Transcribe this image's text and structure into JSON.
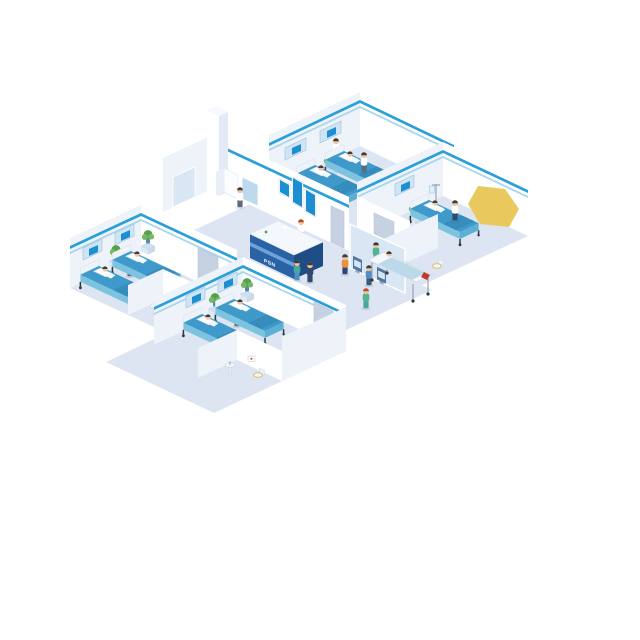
{
  "scene": {
    "subject": "Isometric hospital floor-plan illustration",
    "reception_sign": "PSN",
    "wards": [
      {
        "id": "ward-top",
        "beds": 2,
        "patients": 2,
        "staff": 2,
        "features": [
          "headboard-panels",
          "plant"
        ]
      },
      {
        "id": "ward-right",
        "beds": 1,
        "patients": 1,
        "staff": 1,
        "features": [
          "iv-drip",
          "plant",
          "bathroom"
        ]
      },
      {
        "id": "ward-left",
        "beds": 2,
        "patients": 2,
        "staff": 1,
        "features": [
          "headboard-panels",
          "plants",
          "bathroom"
        ]
      },
      {
        "id": "ward-bottom",
        "beds": 2,
        "patients": 2,
        "staff": 1,
        "features": [
          "headboard-panels",
          "plants",
          "bathroom"
        ]
      }
    ],
    "lobby": {
      "features": [
        "reception-desk",
        "receptionist",
        "wall-display-screens",
        "self-checkin-kiosks"
      ],
      "wall_screens": 3,
      "kiosks": 2,
      "kiosk_users": 2
    },
    "corridor": {
      "people": [
        "doctor-dark-scrubs",
        "assistant-blue",
        "nurse-green-walking"
      ],
      "gurney": {
        "patients": 1,
        "attendants": 1
      }
    },
    "lab_storage": {
      "features": [
        "utility-column",
        "glass-door",
        "medical-cabinet",
        "glass-cabinet",
        "technician"
      ]
    },
    "bathrooms": 3,
    "highlight": {
      "shape": "yellow-polygon",
      "position": "upper-right"
    }
  },
  "palette": {
    "floor": "#dde4f2",
    "wallWhite": "#ffffff",
    "wallShade": "#eef3fa",
    "stripeBlue": "#2b9fd8",
    "stripeLight": "#a9d6ee",
    "panelBlue": "#cfe4f4",
    "screenBlue": "#1d8ed1",
    "doorGray": "#c6d2e2",
    "glassBlue": "#d9e6f4",
    "cabinetBlue": "#bcd9ee",
    "bedTop": "#3e9aca",
    "bedTopDark": "#368cba",
    "bedSide": "#7cc3e0",
    "bedFoot": "#5cb0d6",
    "pillow": "#ffffff",
    "legDark": "#2e3744",
    "metal": "#98a5b3",
    "skin": "#f1c49e",
    "hair": "#3c3c3c",
    "hairRed": "#b2502e",
    "coat": "#ffffff",
    "scrubsGreen": "#55b391",
    "teal": "#4aa6a0",
    "navy": "#2f4a6e",
    "pantsGray": "#5d6b7c",
    "shirtOrange": "#e8923e",
    "shirtBlue": "#4f8fc9",
    "deskFront": "#2a63a5",
    "deskSide": "#1e4d85",
    "deskBand": "#6ea3d8",
    "deskTop": "#f4f8fc",
    "kioskBody": "#55799f",
    "kioskScreen": "#cfe7f7",
    "plantGreen": "#55a04b",
    "plantLight": "#74b961",
    "potBlue": "#5b87b8",
    "tableBlue": "#cfe0ee",
    "gurneyTop": "#f4f8fb",
    "blanketPale": "#bcd9ea",
    "redAccent": "#c0392b",
    "toiletSeat": "#d9c078",
    "sinkBody": "#dfe9f3",
    "yellowShape": "#e9c85e"
  }
}
